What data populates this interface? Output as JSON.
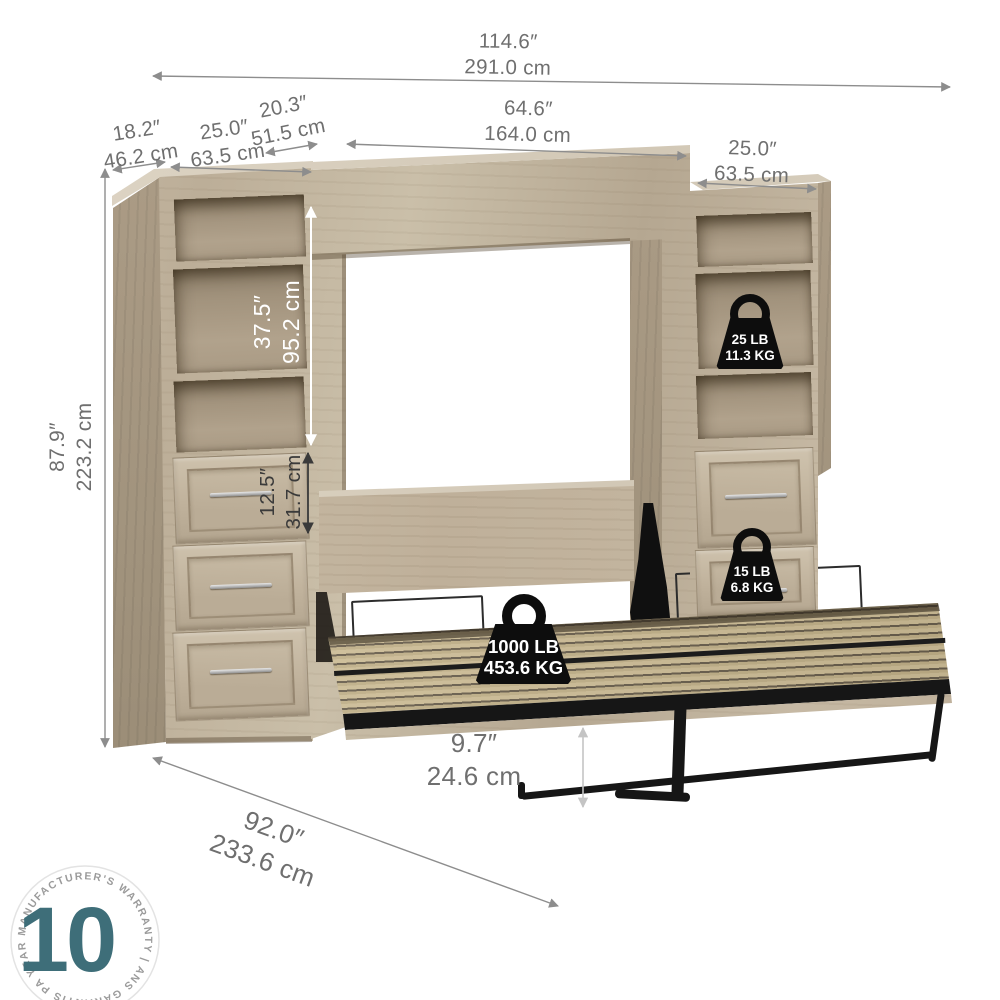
{
  "product": {
    "name": "queen-murphy-bed-with-two-storage-cabinets"
  },
  "colors": {
    "accent_teal": "#3E6E79",
    "dimension_text": "#6F6F6F",
    "badge_black": "#0D0D0D",
    "wood": "#C3B6A0"
  },
  "dims": {
    "overall": {
      "in": "114.6″",
      "cm": "291.0 cm"
    },
    "side_depth": {
      "in": "18.2″",
      "cm": "46.2 cm"
    },
    "left_width": {
      "in": "25.0″",
      "cm": "63.5 cm"
    },
    "hutch_depth": {
      "in": "20.3″",
      "cm": "51.5 cm"
    },
    "bed_width": {
      "in": "64.6″",
      "cm": "164.0 cm"
    },
    "right_width": {
      "in": "25.0″",
      "cm": "63.5 cm"
    },
    "shelf_height": {
      "in": "37.5″",
      "cm": "95.2 cm"
    },
    "overall_height": {
      "in": "87.9″",
      "cm": "223.2 cm"
    },
    "drawer_height": {
      "in": "12.5″",
      "cm": "31.7 cm"
    },
    "clearance": {
      "in": "9.7″",
      "cm": "24.6 cm"
    },
    "open_depth": {
      "in": "92.0″",
      "cm": "233.6 cm"
    }
  },
  "capacities": {
    "shelf": {
      "lb": "25 LB",
      "kg": "11.3 KG"
    },
    "drawer": {
      "lb": "15 LB",
      "kg": "6.8 KG"
    },
    "bed": {
      "lb": "1000 LB",
      "kg": "453.6 KG"
    }
  },
  "warranty": {
    "years": "10",
    "ring_text": "YEAR MANUFACTURER'S WARRANTY   |   ANS GARANTIS PAR LE FABRICANT   |"
  }
}
